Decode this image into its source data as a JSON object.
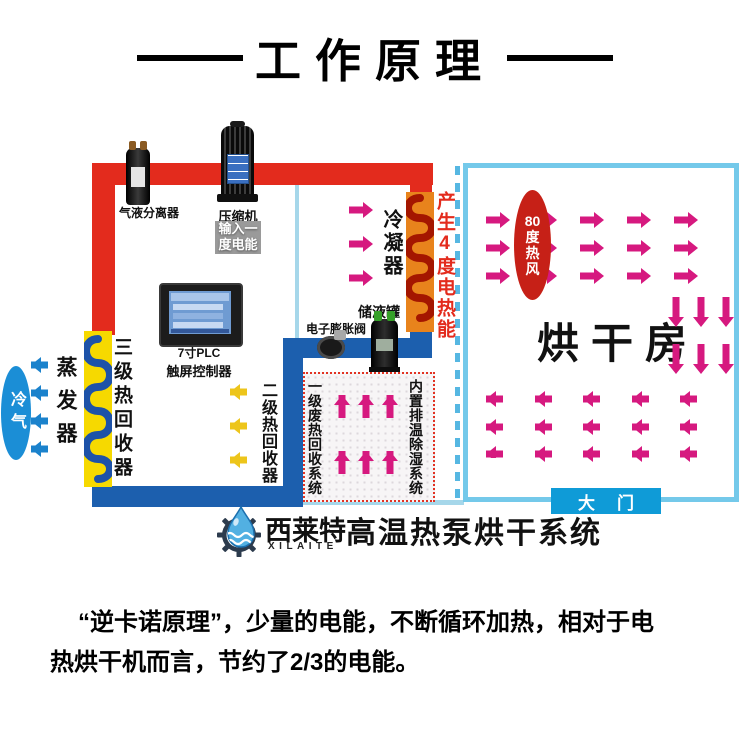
{
  "title": {
    "text": "工作原理"
  },
  "machine_side": {
    "separator_label": "气液分离器",
    "compressor_label": "压缩机",
    "input_energy_badge": [
      "输入一",
      "度电能"
    ],
    "condenser_label": "冷凝器",
    "heat_gain_label": "产生4度电热能",
    "plc_label": [
      "7寸PLC",
      "触屏控制器"
    ],
    "expansion_valve_label": "电子膨胀阀",
    "receiver_tank_label": "储液罐",
    "evaporator_label": "蒸发器",
    "cold_air_badge": "冷气",
    "heat_recovery_3_label": "三级热回收器",
    "heat_recovery_2_label": "二级热回收器",
    "waste_heat_recovery_label": "一级废热回收系统",
    "dehumidifier_label": "内置排温除湿系统"
  },
  "drying_room": {
    "hot_air_badge_lines": [
      "80",
      "度",
      "热",
      "风"
    ],
    "room_name": "烘干房",
    "door_label": "大门"
  },
  "brand_bar": {
    "brand_cn": "西莱特",
    "brand_en": "XILAITE",
    "product_name": "高温热泵烘干系统"
  },
  "description": {
    "line1": "“逆卡诺原理”，少量的电能，不断循环加热，相对于电",
    "line2": "热烘干机而言，节约了2/3的电能。"
  },
  "colors": {
    "hot_pipe": "#e32b1d",
    "cold_pipe": "#1c5fae",
    "condenser_shell": "#e8831c",
    "condenser_coil": "#a41600",
    "recovery_shell": "#f6d900",
    "recovery_coil": "#1d52a8",
    "magenta_arrow": "#d6197f",
    "yellow_arrow": "#edc51b",
    "blue_arrow": "#1b82cc",
    "room_border": "#74c9ea",
    "door_bg": "#0f9bd7",
    "hot_air_badge_bg": "#c62017",
    "cold_air_badge_bg": "#1b8ed6",
    "heat_gain_text": "#e32b1d"
  },
  "icons": {
    "brand-logo": "gear-waterdrop",
    "arrow-right-icon": "▶",
    "arrow-left-icon": "◀",
    "arrow-up-icon": "▲",
    "arrow-down-icon": "▼"
  }
}
